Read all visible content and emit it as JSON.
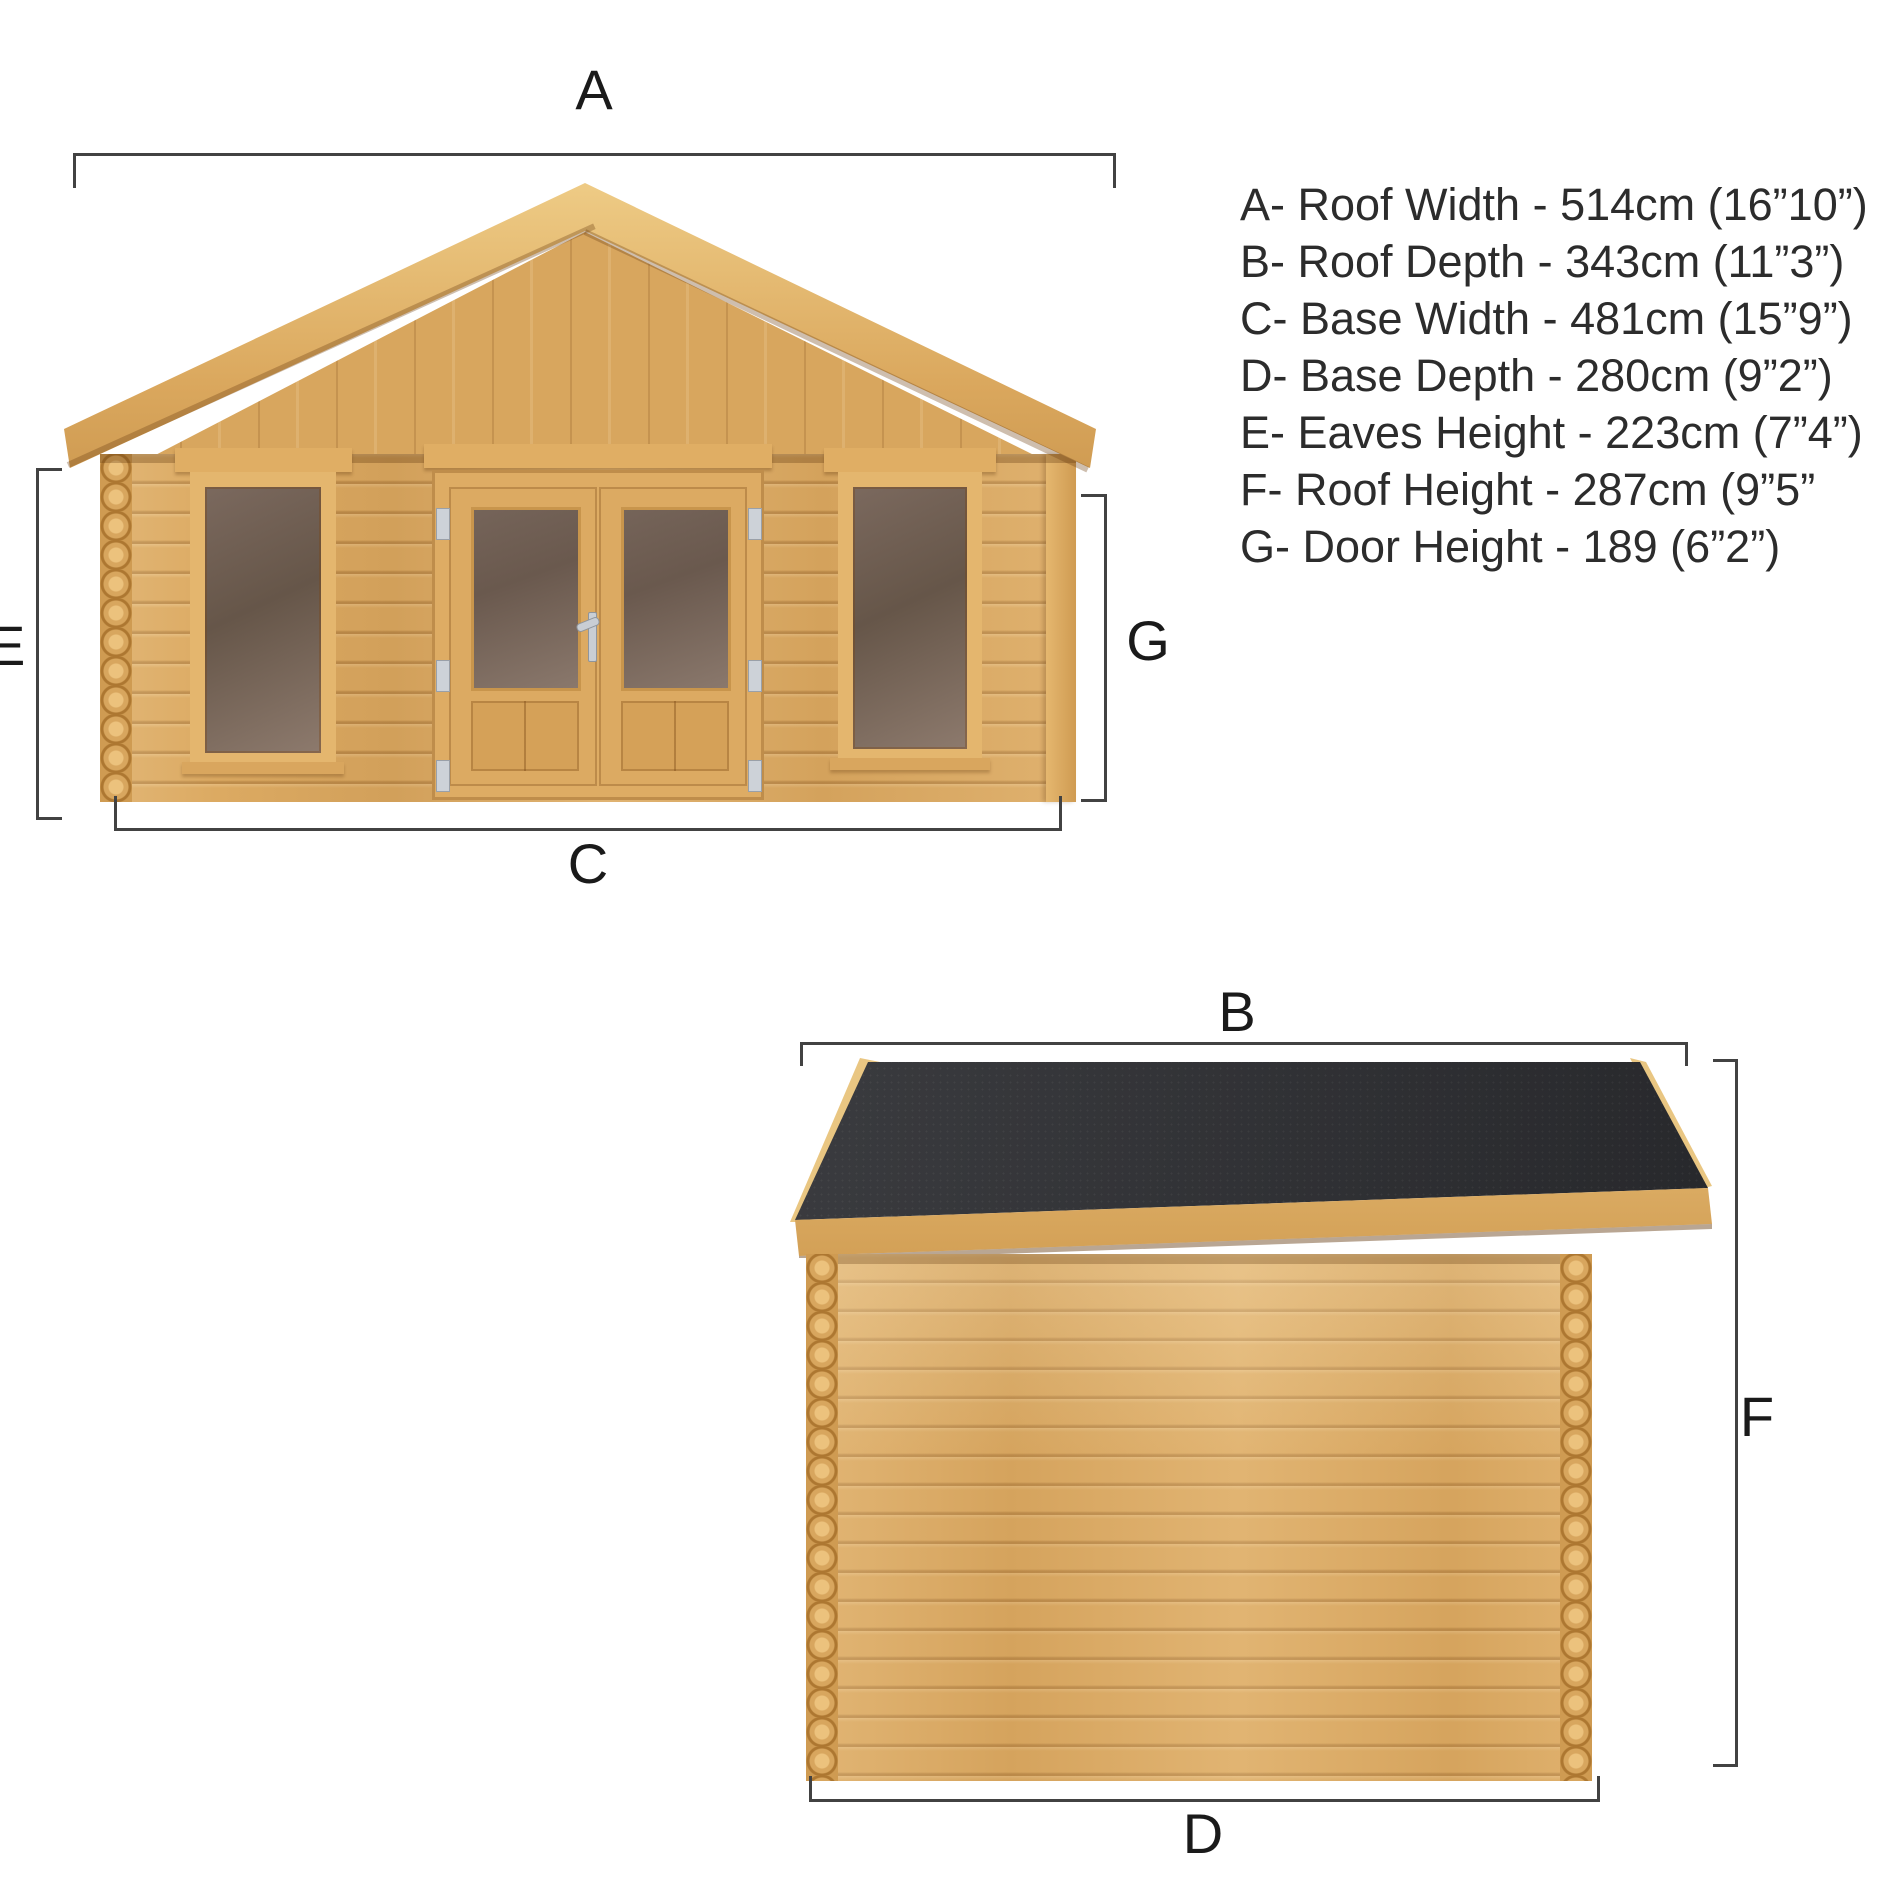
{
  "dims": {
    "a": "A",
    "b": "B",
    "c": "C",
    "d": "D",
    "e": "E",
    "f": "F",
    "g": "G"
  },
  "spec": {
    "lines": [
      "A- Roof Width - 514cm (16”10”)",
      "B- Roof Depth - 343cm (11”3”)",
      "C- Base Width - 481cm (15”9”)",
      "D- Base Depth - 280cm (9”2”)",
      "E- Eaves Height - 223cm (7”4”)",
      "F- Roof Height - 287cm (9”5”",
      "G- Door Height - 189 (6”2”)"
    ]
  },
  "colors": {
    "background": "#ffffff",
    "wood_main": "#dcaa62",
    "wood_light": "#e9c682",
    "wood_dark": "#cf9b52",
    "roof_felt": "#2e2f33",
    "glass": "#6a594e",
    "dimension_line": "#424242",
    "text": "#2c2c2c",
    "hardware_silver": "#cdd2d8"
  }
}
